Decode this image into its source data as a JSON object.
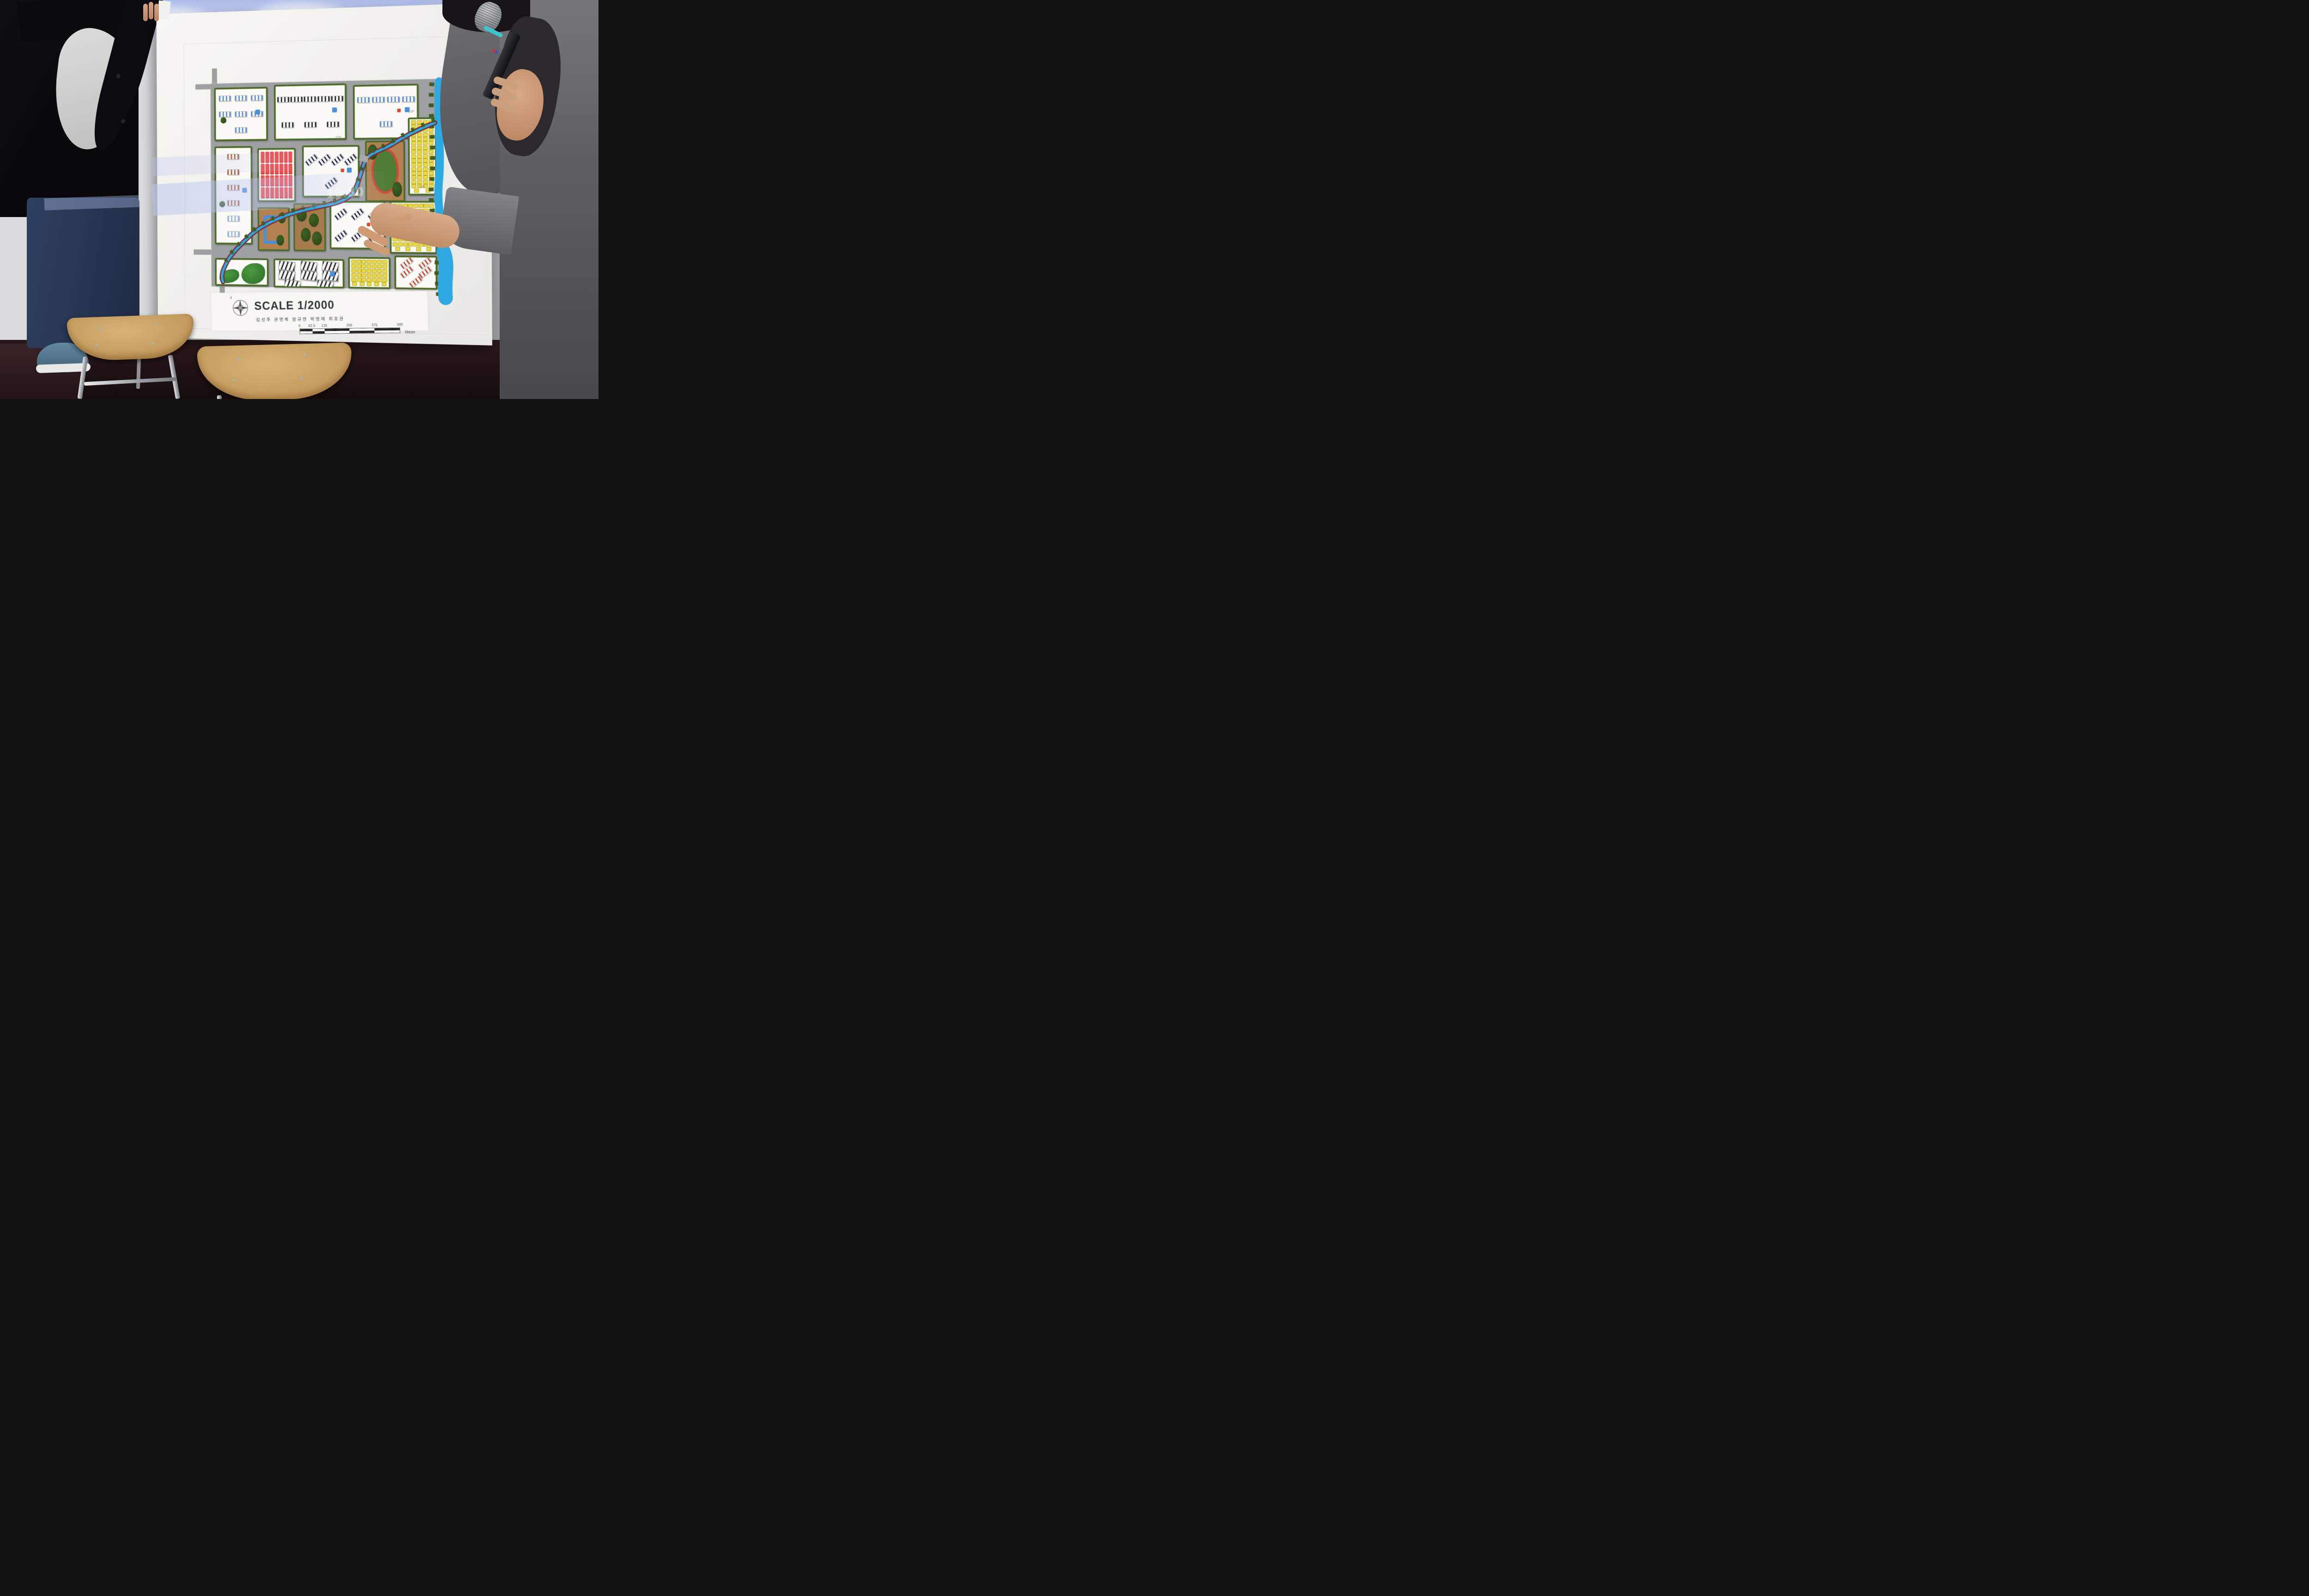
{
  "scene": {
    "setting": "presentation room with projection screen",
    "subject": "urban planning scale model board held by two presenters"
  },
  "board": {
    "legend": {
      "compass_label": "N",
      "scale_label": "SCALE 1/2000",
      "authors": "김성주 권영복 왕규연 박영재 최호권",
      "scale_bar": {
        "ticks": [
          "0",
          "62.5",
          "125",
          "250",
          "375",
          "500"
        ],
        "segment_widths_pct": [
          12.5,
          12.5,
          25,
          25,
          25
        ],
        "unit": "Meter"
      }
    },
    "map_labels": [
      {
        "text": "15F",
        "x": 57,
        "y": 27
      },
      {
        "text": "10F",
        "x": 88.5,
        "y": 15
      },
      {
        "text": "10F",
        "x": 93,
        "y": 51
      }
    ],
    "projection": {
      "clock": "10:30"
    }
  },
  "palette": {
    "road": "#9fa0a2",
    "hedge": "#4b662b",
    "water": "#2ea8e0",
    "bank": "#7a2c35",
    "block_bg": "#fbfaf7",
    "red_block": "#ef4b4b",
    "yellow": "#e8d84a",
    "stadium_ground": "#b5804f",
    "track": "#cc4a3c",
    "field": "#4e7c33",
    "blue_accent": "#4a90d9",
    "red_accent": "#e0482e",
    "blue_roof": "#5b8fd6",
    "black_roof": "#26262c",
    "navy_roof": "#202650",
    "redfin_roof": "#b0502e",
    "palefin_roof": "#8fb7e8",
    "se_roof": "#c04a30"
  },
  "model": {
    "blocks": [
      {
        "id": "apartments-nw",
        "type": "chips",
        "stripe": "blue_roof",
        "count": 7,
        "x": 1.5,
        "y": 2,
        "w": 23,
        "h": 25,
        "extras": [
          "tree",
          "bluecube"
        ]
      },
      {
        "id": "apartments-n",
        "type": "chips",
        "stripe": "black_roof",
        "count": 8,
        "x": 28.5,
        "y": 1,
        "w": 31,
        "h": 26,
        "extras": [
          "bluecube"
        ]
      },
      {
        "id": "apartments-ne",
        "type": "chips",
        "stripe": "blue_roof",
        "count": 5,
        "x": 63.5,
        "y": 2,
        "w": 27,
        "h": 25,
        "extras": [
          "redcube",
          "bluecube"
        ]
      },
      {
        "id": "residences-w",
        "type": "chips-v",
        "stripes": [
          "redfin_roof",
          "redfin_roof",
          "redfin_roof",
          "redfin_roof",
          "palefin_roof",
          "palefin_roof"
        ],
        "count": 6,
        "x": 1.5,
        "y": 31,
        "w": 16,
        "h": 47,
        "extras": [
          "tree",
          "bluecube"
        ]
      },
      {
        "id": "market-red",
        "type": "red-grid",
        "x": 21,
        "y": 32,
        "w": 16,
        "h": 25
      },
      {
        "id": "apartments-c",
        "type": "chips",
        "diag": true,
        "stripe": "navy_roof",
        "count": 5,
        "x": 41,
        "y": 31,
        "w": 24,
        "h": 24,
        "extras": [
          "redcube",
          "bluecube"
        ]
      },
      {
        "id": "stadium",
        "type": "stadium",
        "x": 68.5,
        "y": 29,
        "w": 16,
        "h": 28
      },
      {
        "id": "rowhouses-e",
        "type": "yellow",
        "x": 87,
        "y": 18,
        "w": 11,
        "h": 36
      },
      {
        "id": "rowhouses-se",
        "type": "yellow",
        "x": 79,
        "y": 58,
        "w": 19,
        "h": 24
      },
      {
        "id": "courtyard-sw",
        "type": "courtyard",
        "x": 21,
        "y": 61,
        "w": 13,
        "h": 20
      },
      {
        "id": "greens-c",
        "type": "courtyard2",
        "x": 37,
        "y": 59,
        "w": 13,
        "h": 22
      },
      {
        "id": "apartments-s",
        "type": "chips",
        "diag": true,
        "stripe": "navy_roof",
        "count": 6,
        "x": 53,
        "y": 58,
        "w": 23,
        "h": 22,
        "extras": [
          "redcube",
          "bluecube"
        ]
      },
      {
        "id": "park-sw",
        "type": "park",
        "x": 1.5,
        "y": 86,
        "w": 23,
        "h": 12.5
      },
      {
        "id": "industry-s",
        "type": "industrial",
        "count": 8,
        "x": 28,
        "y": 86,
        "w": 30,
        "h": 13,
        "extras": [
          "bluecube"
        ]
      },
      {
        "id": "rowhouses-s",
        "type": "yellow",
        "x": 61,
        "y": 85,
        "w": 17,
        "h": 14
      },
      {
        "id": "residences-se",
        "type": "chips",
        "diag": true,
        "stripe": "se_roof",
        "count": 5,
        "x": 81,
        "y": 84,
        "w": 17,
        "h": 15
      }
    ]
  }
}
